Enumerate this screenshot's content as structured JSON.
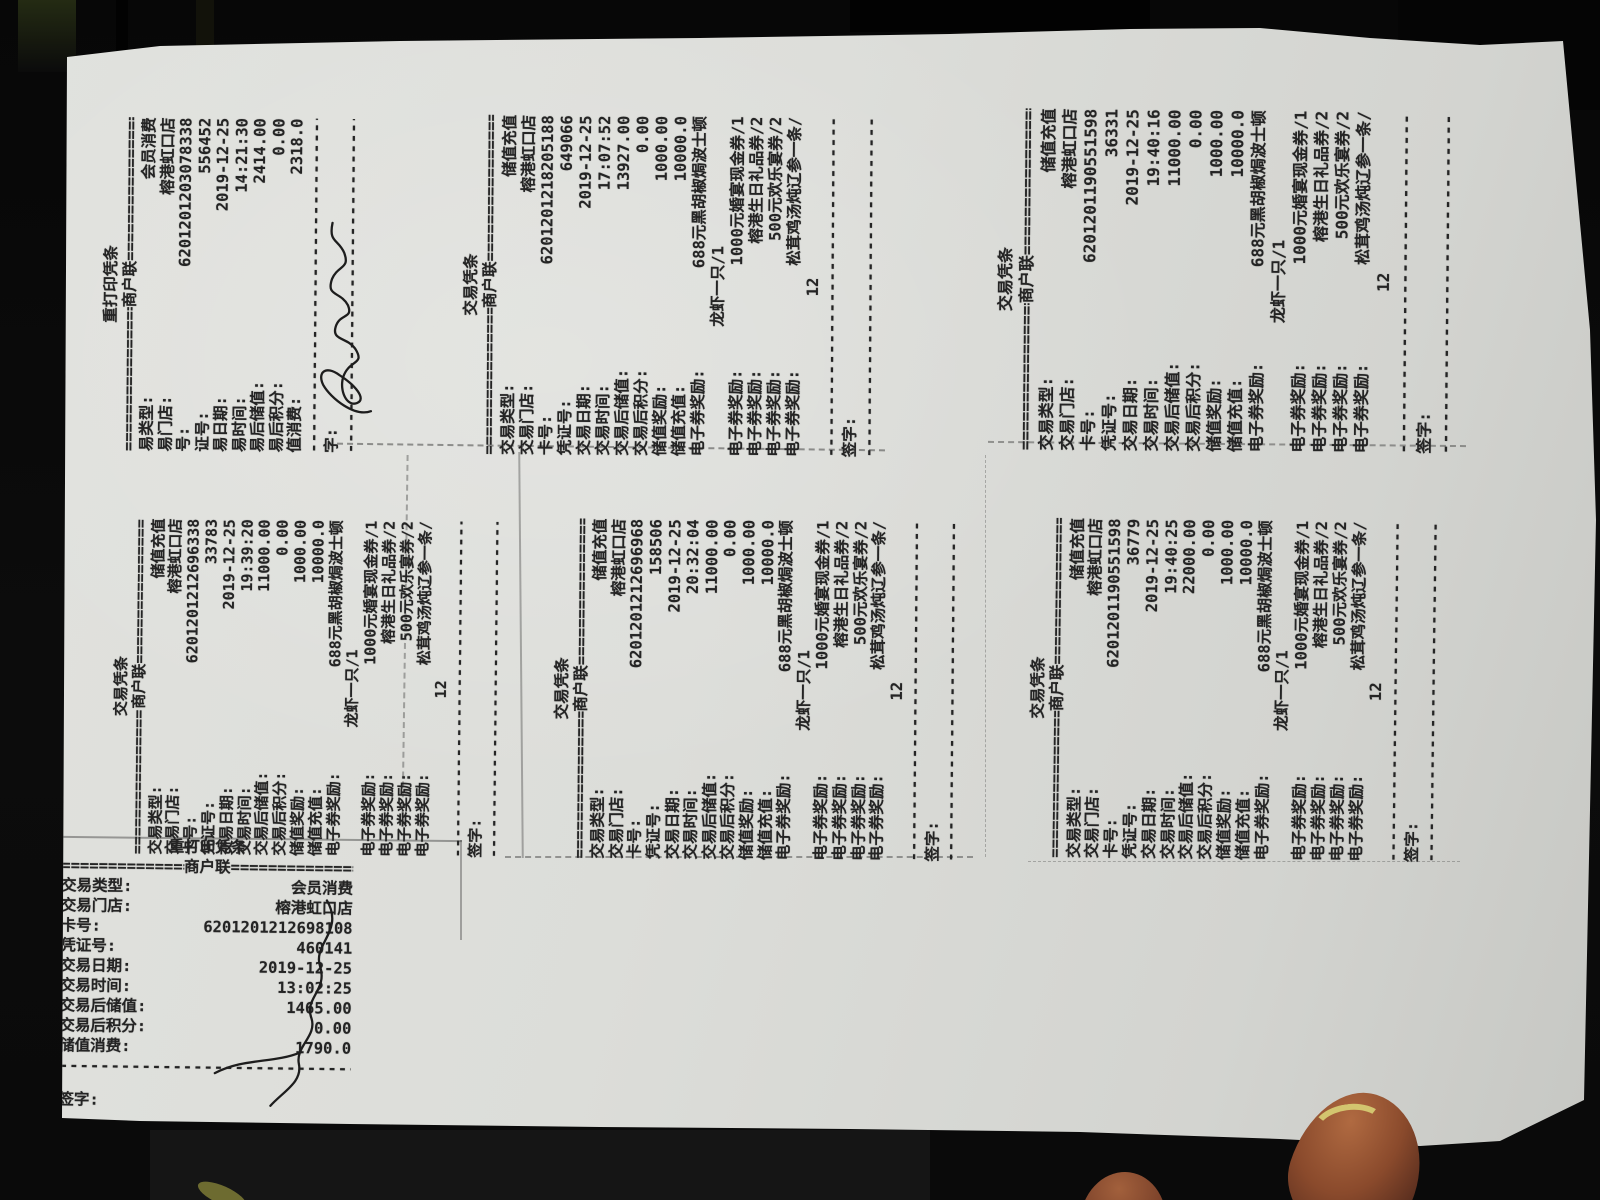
{
  "colors": {
    "paper": "#dcddd9",
    "background": "#0b0b0b",
    "ink": "#242424",
    "finger": "#8a4a2c",
    "nail": "#d3c56f"
  },
  "strings": {
    "band_dash": "================",
    "sep": "------------------------------------------"
  },
  "receipts": [
    {
      "id": "reprint-556452",
      "header": "重打印凭条",
      "band_center": "商户联",
      "rows": [
        {
          "label": "易类型:",
          "value": "会员消费"
        },
        {
          "label": "易门店:",
          "value": "榕港虹口店"
        },
        {
          "label": "号:",
          "value": "6201201203078338"
        },
        {
          "label": "证号:",
          "value": "556452"
        },
        {
          "label": "易日期:",
          "value": "2019-12-25"
        },
        {
          "label": "易时间:",
          "value": "14:21:30"
        },
        {
          "label": "易后储值:",
          "value": "2414.00"
        },
        {
          "label": "易后积分:",
          "value": "0.00"
        },
        {
          "label": "值消费:",
          "value": "2318.0"
        }
      ],
      "sign_label": "字:",
      "signature_present": true,
      "trailing_sep": true
    },
    {
      "id": "recharge-649066",
      "header": "交易凭条",
      "band_center": "商户联",
      "rows": [
        {
          "label": "交易类型:",
          "value": "储值充值"
        },
        {
          "label": "交易门店:",
          "value": "榕港虹口店"
        },
        {
          "label": "卡号:",
          "value": "6201201218205188"
        },
        {
          "label": "凭证号:",
          "value": "649066"
        },
        {
          "label": "交易日期:",
          "value": "2019-12-25"
        },
        {
          "label": "交易时间:",
          "value": "17:07:52"
        },
        {
          "label": "交易后储值:",
          "value": "13927.00"
        },
        {
          "label": "交易后积分:",
          "value": "0.00"
        },
        {
          "label": "储值奖励:",
          "value": "1000.00"
        },
        {
          "label": "储值充值:",
          "value": "10000.0"
        }
      ],
      "coupons": [
        {
          "label": "电子券奖励:",
          "value": "688元黑胡椒焗波士顿",
          "value2": "龙虾一只/1"
        },
        {
          "label": "电子券奖励:",
          "value": "1000元婚宴现金券/1"
        },
        {
          "label": "电子券奖励:",
          "value": "榕港生日礼品券/2"
        },
        {
          "label": "电子券奖励:",
          "value": "500元欢乐宴券/2"
        },
        {
          "label": "电子券奖励:",
          "value": "松茸鸡汤炖辽参一条/",
          "value2": "12"
        }
      ],
      "sign_label": "签字:",
      "signature_present": false,
      "trailing_sep": true
    },
    {
      "id": "recharge-36331",
      "header": "交易凭条",
      "band_center": "商户联",
      "rows": [
        {
          "label": "交易类型:",
          "value": "储值充值"
        },
        {
          "label": "交易门店:",
          "value": "榕港虹口店"
        },
        {
          "label": "卡号:",
          "value": "6201201190551598"
        },
        {
          "label": "凭证号:",
          "value": "36331"
        },
        {
          "label": "交易日期:",
          "value": "2019-12-25"
        },
        {
          "label": "交易时间:",
          "value": "19:40:16"
        },
        {
          "label": "交易后储值:",
          "value": "11000.00"
        },
        {
          "label": "交易后积分:",
          "value": "0.00"
        },
        {
          "label": "储值奖励:",
          "value": "1000.00"
        },
        {
          "label": "储值充值:",
          "value": "10000.0"
        }
      ],
      "coupons": [
        {
          "label": "电子券奖励:",
          "value": "688元黑胡椒焗波士顿",
          "value2": "龙虾一只/1"
        },
        {
          "label": "电子券奖励:",
          "value": "1000元婚宴现金券/1"
        },
        {
          "label": "电子券奖励:",
          "value": "榕港生日礼品券/2"
        },
        {
          "label": "电子券奖励:",
          "value": "500元欢乐宴券/2"
        },
        {
          "label": "电子券奖励:",
          "value": "松茸鸡汤炖辽参一条/",
          "value2": "12"
        }
      ],
      "sign_label": "签字:",
      "signature_present": false,
      "trailing_sep": true
    },
    {
      "id": "recharge-33783",
      "header": "交易凭条",
      "band_center": "商户联",
      "rows": [
        {
          "label": "交易类型:",
          "value": "储值充值"
        },
        {
          "label": "交易门店:",
          "value": "榕港虹口店"
        },
        {
          "label": "卡号:",
          "value": "6201201212696338"
        },
        {
          "label": "凭证号:",
          "value": "33783"
        },
        {
          "label": "交易日期:",
          "value": "2019-12-25"
        },
        {
          "label": "交易时间:",
          "value": "19:39:20"
        },
        {
          "label": "交易后储值:",
          "value": "11000.00"
        },
        {
          "label": "交易后积分:",
          "value": "0.00"
        },
        {
          "label": "储值奖励:",
          "value": "1000.00"
        },
        {
          "label": "储值充值:",
          "value": "10000.0"
        }
      ],
      "coupons": [
        {
          "label": "电子券奖励:",
          "value": "688元黑胡椒焗波士顿",
          "value2": "龙虾一只/1"
        },
        {
          "label": "电子券奖励:",
          "value": "1000元婚宴现金券/1"
        },
        {
          "label": "电子券奖励:",
          "value": "榕港生日礼品券/2"
        },
        {
          "label": "电子券奖励:",
          "value": "500元欢乐宴券/2"
        },
        {
          "label": "电子券奖励:",
          "value": "松茸鸡汤炖辽参一条/",
          "value2": "12"
        }
      ],
      "sign_label": "签字:",
      "signature_present": false,
      "trailing_sep": true
    },
    {
      "id": "recharge-158506",
      "header": "交易凭条",
      "band_center": "商户联",
      "rows": [
        {
          "label": "交易类型:",
          "value": "储值充值"
        },
        {
          "label": "交易门店:",
          "value": "榕港虹口店"
        },
        {
          "label": "卡号:",
          "value": "6201201212696968"
        },
        {
          "label": "凭证号:",
          "value": "158506"
        },
        {
          "label": "交易日期:",
          "value": "2019-12-25"
        },
        {
          "label": "交易时间:",
          "value": "20:32:04"
        },
        {
          "label": "交易后储值:",
          "value": "11000.00"
        },
        {
          "label": "交易后积分:",
          "value": "0.00"
        },
        {
          "label": "储值奖励:",
          "value": "1000.00"
        },
        {
          "label": "储值充值:",
          "value": "10000.0"
        }
      ],
      "coupons": [
        {
          "label": "电子券奖励:",
          "value": "688元黑胡椒焗波士顿",
          "value2": "龙虾一只/1"
        },
        {
          "label": "电子券奖励:",
          "value": "1000元婚宴现金券/1"
        },
        {
          "label": "电子券奖励:",
          "value": "榕港生日礼品券/2"
        },
        {
          "label": "电子券奖励:",
          "value": "500元欢乐宴券/2"
        },
        {
          "label": "电子券奖励:",
          "value": "松茸鸡汤炖辽参一条/",
          "value2": "12"
        }
      ],
      "sign_label": "签字:",
      "signature_present": false,
      "trailing_sep": true
    },
    {
      "id": "recharge-36779",
      "header": "交易凭条",
      "band_center": "商户联",
      "rows": [
        {
          "label": "交易类型:",
          "value": "储值充值"
        },
        {
          "label": "交易门店:",
          "value": "榕港虹口店"
        },
        {
          "label": "卡号:",
          "value": "6201201190551598"
        },
        {
          "label": "凭证号:",
          "value": "36779"
        },
        {
          "label": "交易日期:",
          "value": "2019-12-25"
        },
        {
          "label": "交易时间:",
          "value": "19:40:25"
        },
        {
          "label": "交易后储值:",
          "value": "22000.00"
        },
        {
          "label": "交易后积分:",
          "value": "0.00"
        },
        {
          "label": "储值奖励:",
          "value": "1000.00"
        },
        {
          "label": "储值充值:",
          "value": "10000.0"
        }
      ],
      "coupons": [
        {
          "label": "电子券奖励:",
          "value": "688元黑胡椒焗波士顿",
          "value2": "龙虾一只/1"
        },
        {
          "label": "电子券奖励:",
          "value": "1000元婚宴现金券/1"
        },
        {
          "label": "电子券奖励:",
          "value": "榕港生日礼品券/2"
        },
        {
          "label": "电子券奖励:",
          "value": "500元欢乐宴券/2"
        },
        {
          "label": "电子券奖励:",
          "value": "松茸鸡汤炖辽参一条/",
          "value2": "12"
        }
      ],
      "sign_label": "签字:",
      "signature_present": false,
      "trailing_sep": true
    },
    {
      "id": "reprint-460141",
      "header": "重打印凭条",
      "band_center": "商户联",
      "rows": [
        {
          "label": "交易类型:",
          "value": "会员消费"
        },
        {
          "label": "交易门店:",
          "value": "榕港虹口店"
        },
        {
          "label": "卡号:",
          "value": "6201201212698108"
        },
        {
          "label": "凭证号:",
          "value": "460141"
        },
        {
          "label": "交易日期:",
          "value": "2019-12-25"
        },
        {
          "label": "交易时间:",
          "value": "13:02:25"
        },
        {
          "label": "交易后储值:",
          "value": "1465.00"
        },
        {
          "label": "交易后积分:",
          "value": "0.00"
        },
        {
          "label": "储值消费:",
          "value": "1790.0"
        }
      ],
      "sign_label": "签字:",
      "sign_gap": true,
      "signature_present": true,
      "trailing_sep": false
    }
  ]
}
